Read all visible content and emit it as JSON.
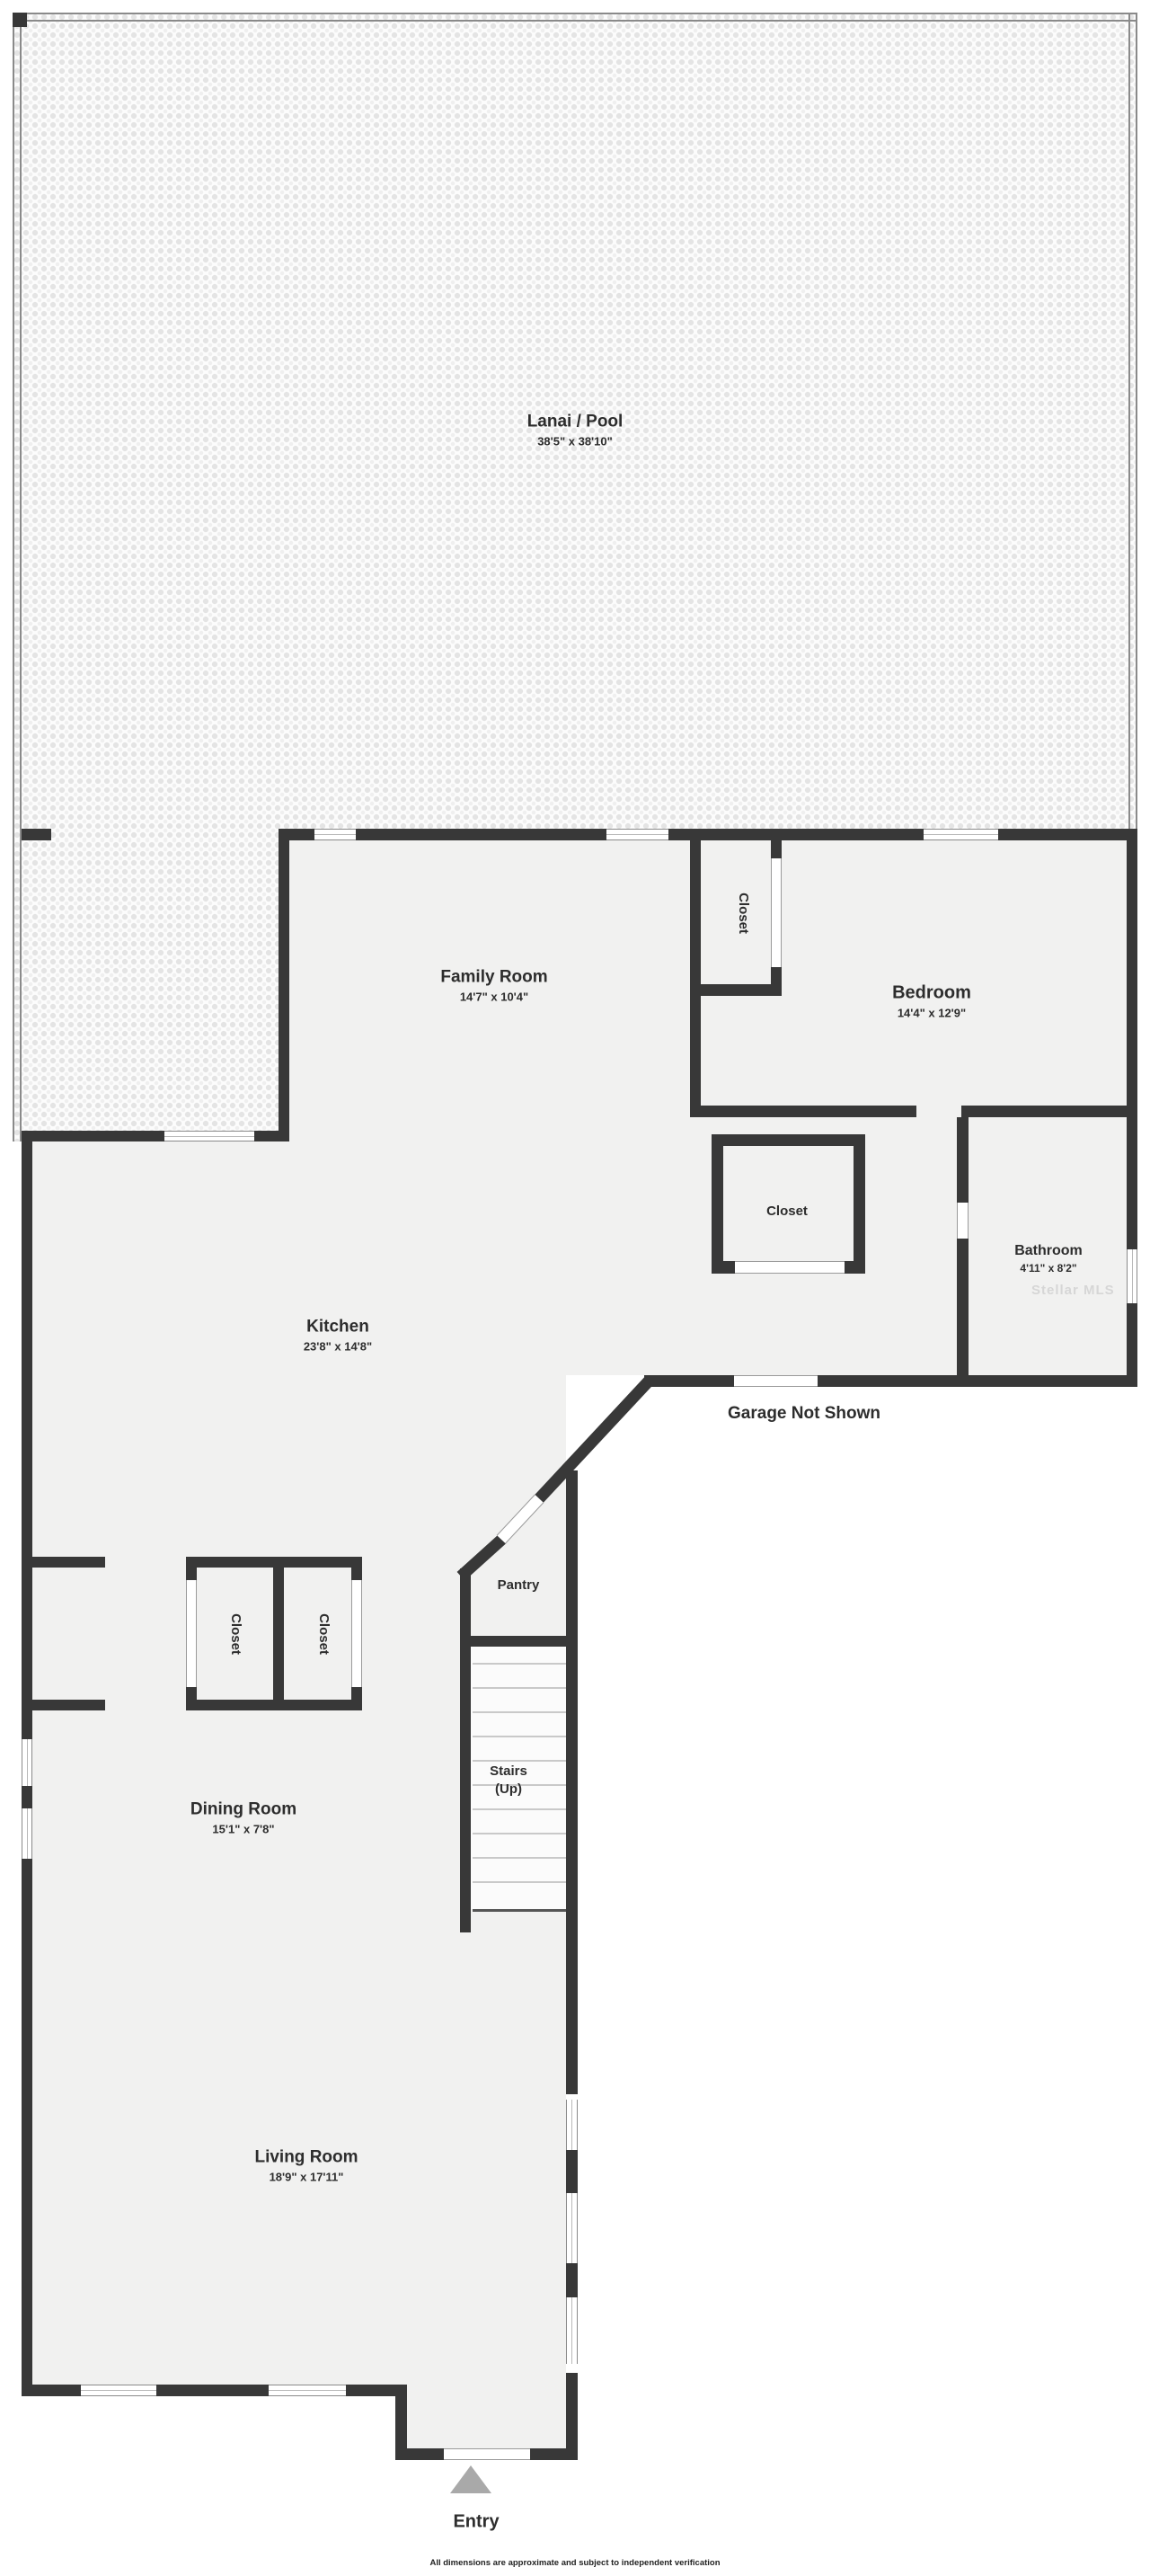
{
  "rooms": {
    "lanai": {
      "name": "Lanai / Pool",
      "dims": "38'5\" x 38'10\""
    },
    "family": {
      "name": "Family Room",
      "dims": "14'7\" x 10'4\""
    },
    "bedroom": {
      "name": "Bedroom",
      "dims": "14'4\" x 12'9\""
    },
    "bathroom": {
      "name": "Bathroom",
      "dims": "4'11\" x 8'2\""
    },
    "kitchen": {
      "name": "Kitchen",
      "dims": "23'8\" x 14'8\""
    },
    "dining": {
      "name": "Dining Room",
      "dims": "15'1\" x 7'8\""
    },
    "living": {
      "name": "Living Room",
      "dims": "18'9\" x 17'11\""
    },
    "pantry": {
      "name": "Pantry"
    },
    "stairs": {
      "name": "Stairs",
      "direction": "(Up)"
    },
    "entry": {
      "name": "Entry"
    },
    "closet_bedroom": {
      "name": "Closet"
    },
    "closet_hall": {
      "name": "Closet"
    },
    "closet_dining_left": {
      "name": "Closet"
    },
    "closet_dining_right": {
      "name": "Closet"
    }
  },
  "annotations": {
    "garage_note": "Garage Not Shown",
    "watermark": "Stellar MLS",
    "disclaimer": "All dimensions are approximate and subject to independent verification"
  },
  "colors": {
    "wall": "#383838",
    "floor": "#f1f1f0",
    "entry_triangle": "#a9a9a9"
  }
}
